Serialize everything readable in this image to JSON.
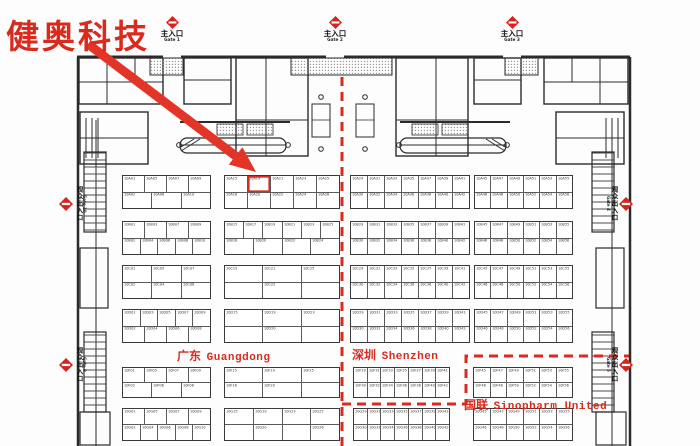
{
  "colors": {
    "red": "#da2a1d",
    "wall": "#2b2b2b",
    "booth_line": "#4a4a4a"
  },
  "annotations": {
    "company": "健奥科技",
    "highlight_booth": "10A19",
    "regions": {
      "guangdong": {
        "zh": "广东",
        "en": "Guangdong"
      },
      "shenzhen": {
        "zh": "深圳",
        "en": "Shenzhen"
      },
      "sinopharm": {
        "zh": "国联",
        "en": "Sinopharm United"
      }
    }
  },
  "gates": {
    "top": [
      {
        "zh": "主入口",
        "en": "Gate 1"
      },
      {
        "zh": "主入口",
        "en": "Gate 2"
      },
      {
        "zh": "主入口",
        "en": "Gate 3"
      }
    ],
    "side": [
      {
        "zh": "观众出入口",
        "en": "Gate 10"
      },
      {
        "zh": "观众出入口",
        "en": "Gate 9"
      },
      {
        "zh": "观众出入口",
        "en": "Gate 4"
      },
      {
        "zh": "观众出入口",
        "en": "Gate 5"
      }
    ]
  },
  "floor": {
    "blocks": [
      {
        "x": 122,
        "y": 175,
        "w": 89,
        "h": 34,
        "rows": [
          [
            "10A01",
            "10A05",
            "10A07",
            "10A09"
          ],
          [
            "10A02",
            "10A08",
            "10A10"
          ]
        ]
      },
      {
        "x": 224,
        "y": 175,
        "w": 116,
        "h": 34,
        "rows": [
          [
            "10A15",
            "10A19",
            "10A21",
            "10A23",
            "10A25"
          ],
          [
            "10A16",
            "10A20",
            "10A22",
            "10A24",
            "10A26"
          ]
        ]
      },
      {
        "x": 350,
        "y": 175,
        "w": 120,
        "h": 34,
        "rows": [
          [
            "10A29",
            "10A31",
            "10A33",
            "10A35",
            "10A37",
            "10A39",
            "10A41"
          ],
          [
            "10A30",
            "10A32",
            "10A34",
            "10A36",
            "10A38",
            "10A40",
            "10A42"
          ]
        ]
      },
      {
        "x": 474,
        "y": 175,
        "w": 99,
        "h": 34,
        "rows": [
          [
            "10A45",
            "10A47",
            "10A49",
            "10A51",
            "10A53",
            "10A55"
          ],
          [
            "10A46",
            "10A48",
            "10A50",
            "10A52",
            "10A54",
            "10A56"
          ]
        ]
      },
      {
        "x": 122,
        "y": 221,
        "w": 89,
        "h": 34,
        "rows": [
          [
            "10B01",
            "10B03",
            "10B07",
            "10B09"
          ],
          [
            "10B02",
            "10B04",
            "10B06",
            "10B08",
            "10B10"
          ]
        ]
      },
      {
        "x": 224,
        "y": 221,
        "w": 116,
        "h": 34,
        "rows": [
          [
            "10B15",
            "10B17",
            "10B19",
            "10B21",
            "10B23",
            "10B25"
          ],
          [
            "10B16",
            "10B20",
            "10B22",
            "10B24"
          ]
        ]
      },
      {
        "x": 350,
        "y": 221,
        "w": 120,
        "h": 34,
        "rows": [
          [
            "10B29",
            "10B31",
            "10B33",
            "10B35",
            "10B37",
            "10B39",
            "10B41"
          ],
          [
            "10B30",
            "10B32",
            "10B34",
            "10B36",
            "10B38",
            "10B40",
            "10B42"
          ]
        ]
      },
      {
        "x": 474,
        "y": 221,
        "w": 99,
        "h": 34,
        "rows": [
          [
            "10B45",
            "10B47",
            "10B49",
            "10B51",
            "10B53",
            "10B55"
          ],
          [
            "10B46",
            "10B48",
            "10B50",
            "10B52",
            "10B54",
            "10B56"
          ]
        ]
      },
      {
        "x": 122,
        "y": 265,
        "w": 89,
        "h": 34,
        "rows": [
          [
            "10C01",
            "10C05",
            "10C07"
          ],
          [
            "10C02",
            "10C04",
            "10C06"
          ]
        ]
      },
      {
        "x": 224,
        "y": 265,
        "w": 116,
        "h": 34,
        "rows": [
          [
            "10C15",
            "10C21",
            "10C25"
          ],
          [
            "",
            "10C22",
            ""
          ]
        ]
      },
      {
        "x": 350,
        "y": 265,
        "w": 120,
        "h": 34,
        "rows": [
          [
            "10C29",
            "10C31",
            "10C33",
            "10C35",
            "10C37",
            "10C39",
            "10C41"
          ],
          [
            "10C30",
            "10C32",
            "10C34",
            "10C36",
            "10C38",
            "10C40",
            "10C42"
          ]
        ]
      },
      {
        "x": 474,
        "y": 265,
        "w": 99,
        "h": 34,
        "rows": [
          [
            "10C45",
            "10C47",
            "10C49",
            "10C51",
            "10C53",
            "10C55"
          ],
          [
            "10C46",
            "10C48",
            "10C50",
            "10C52",
            "10C54",
            "10C56"
          ]
        ]
      },
      {
        "x": 122,
        "y": 309,
        "w": 89,
        "h": 34,
        "rows": [
          [
            "10D01",
            "10D03",
            "10D05",
            "10D07",
            "10D09"
          ],
          [
            "10D02",
            "10D04",
            "10D06",
            "10D08"
          ]
        ]
      },
      {
        "x": 224,
        "y": 309,
        "w": 116,
        "h": 34,
        "rows": [
          [
            "10D15",
            "10D19",
            "10D23"
          ],
          [
            "",
            "10D20",
            ""
          ]
        ]
      },
      {
        "x": 350,
        "y": 309,
        "w": 120,
        "h": 34,
        "rows": [
          [
            "10D29",
            "10D31",
            "10D33",
            "10D35",
            "10D37",
            "10D39",
            "10D41"
          ],
          [
            "10D30",
            "10D32",
            "10D34",
            "10D36",
            "10D38",
            "10D40",
            "10D42"
          ]
        ]
      },
      {
        "x": 474,
        "y": 309,
        "w": 99,
        "h": 34,
        "rows": [
          [
            "10D45",
            "10D47",
            "10D49",
            "10D51",
            "10D53",
            "10D55"
          ],
          [
            "10D46",
            "10D48",
            "10D50",
            "10D52",
            "10D54",
            "10D56"
          ]
        ]
      },
      {
        "x": 122,
        "y": 367,
        "w": 89,
        "h": 31,
        "rows": [
          [
            "10F01",
            "10F05",
            "10F07",
            "10F09"
          ],
          [
            "10F02",
            "10F06",
            "10F08"
          ]
        ]
      },
      {
        "x": 224,
        "y": 367,
        "w": 116,
        "h": 31,
        "rows": [
          [
            "10F15",
            "10F19",
            "10F25"
          ],
          [
            "10F16",
            "10F20",
            ""
          ]
        ]
      },
      {
        "x": 353,
        "y": 367,
        "w": 97,
        "h": 31,
        "rows": [
          [
            "10F29",
            "10F31",
            "10F33",
            "10F35",
            "10F37",
            "10F39",
            "10F41"
          ],
          [
            "10F30",
            "10F32",
            "10F34",
            "10F36",
            "10F38",
            "10F40",
            "10F42"
          ]
        ]
      },
      {
        "x": 473,
        "y": 367,
        "w": 100,
        "h": 31,
        "rows": [
          [
            "10F45",
            "10F47",
            "10F49",
            "10F51",
            "10F53",
            "10F55"
          ],
          [
            "10F46",
            "10F48",
            "10F50",
            "10F52",
            "10F54",
            "10F56"
          ]
        ]
      },
      {
        "x": 122,
        "y": 408,
        "w": 89,
        "h": 33,
        "rows": [
          [
            "10G01",
            "10G05",
            "10G07",
            "10G09"
          ],
          [
            "10G02",
            "10G04",
            "10G06",
            "10G08",
            "10G10"
          ]
        ]
      },
      {
        "x": 224,
        "y": 408,
        "w": 116,
        "h": 33,
        "rows": [
          [
            "10G15",
            "10G19",
            "10G23",
            "10G25"
          ],
          [
            "",
            "10G20",
            "",
            "10G26"
          ]
        ]
      },
      {
        "x": 353,
        "y": 408,
        "w": 97,
        "h": 33,
        "rows": [
          [
            "10G29",
            "10G31",
            "10G33",
            "10G35",
            "10G37",
            "10G39",
            "10G41"
          ],
          [
            "10G30",
            "10G32",
            "10G34",
            "10G36",
            "10G38",
            "10G40",
            "10G42"
          ]
        ]
      },
      {
        "x": 473,
        "y": 408,
        "w": 100,
        "h": 33,
        "rows": [
          [
            "10G45",
            "10G47",
            "10G49",
            "10G51",
            "10G53",
            "10G55"
          ],
          [
            "10G46",
            "10G48",
            "10G50",
            "10G52",
            "10G54",
            "10G56"
          ]
        ]
      }
    ]
  }
}
